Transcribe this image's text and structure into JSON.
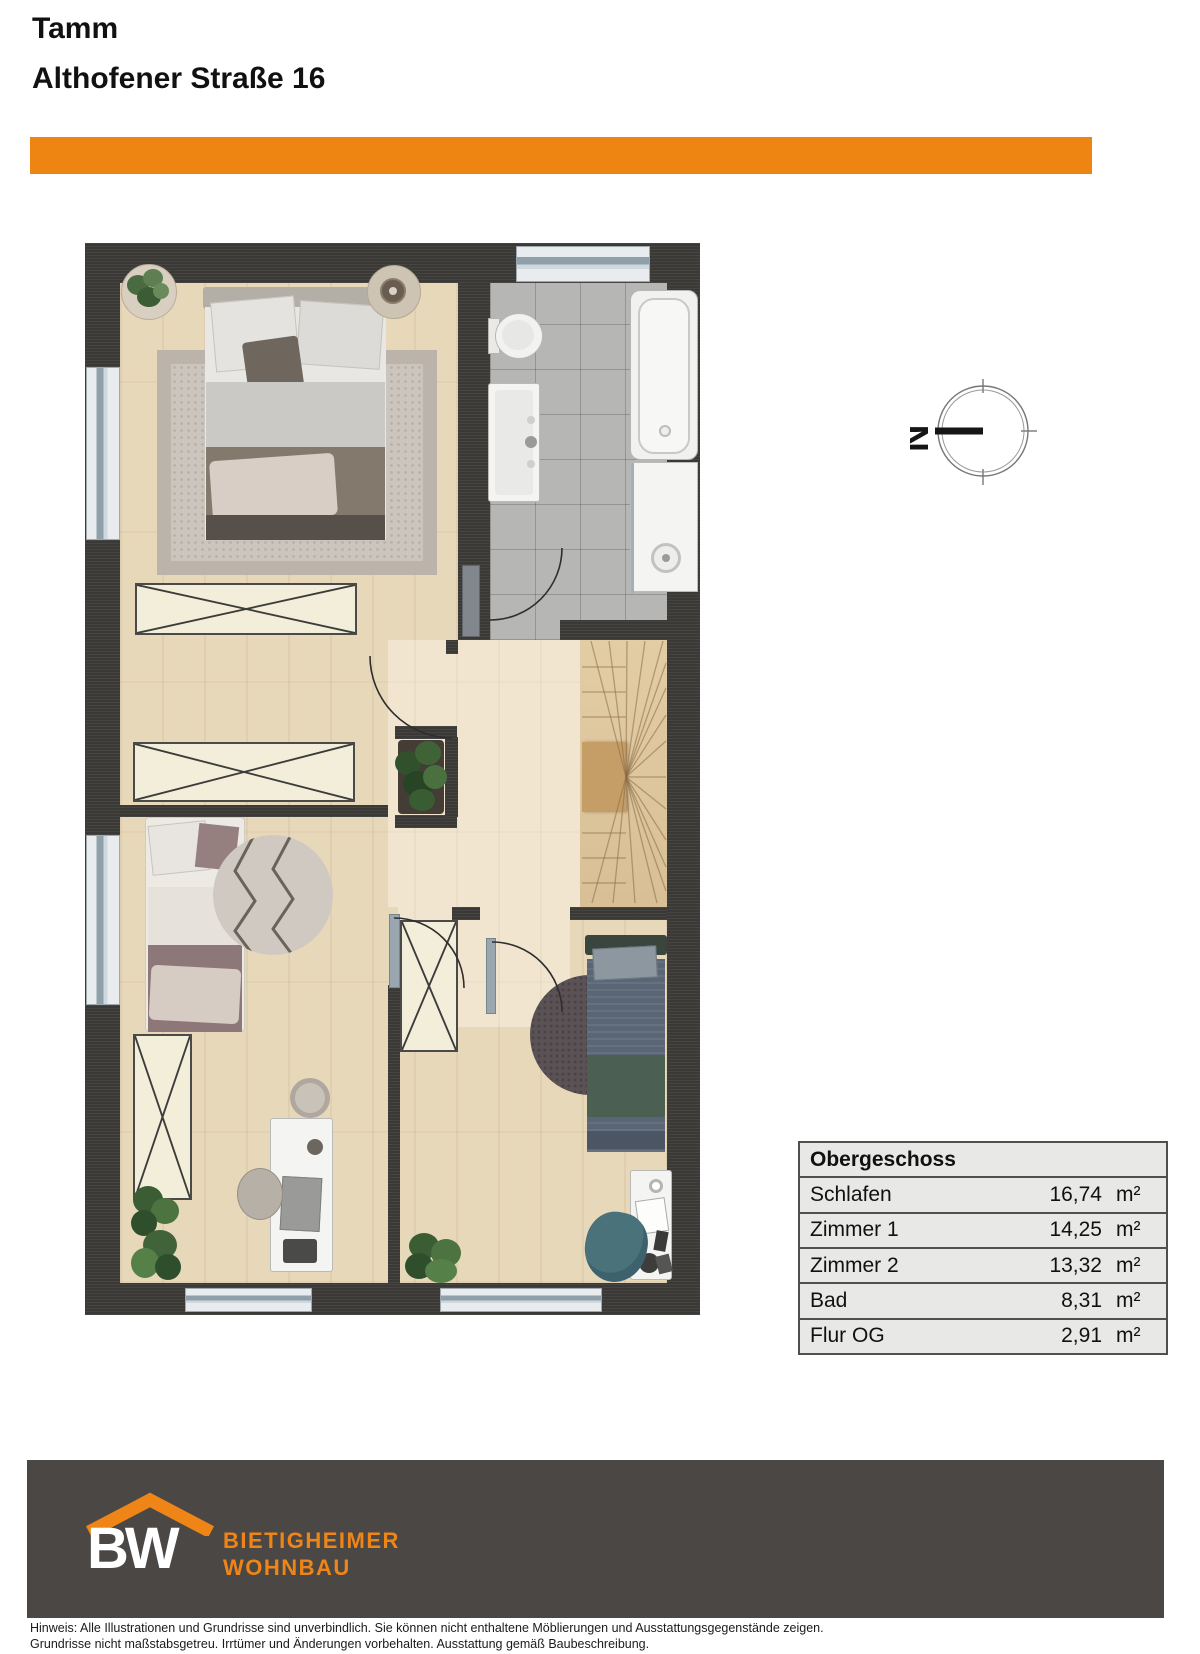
{
  "header": {
    "city": "Tamm",
    "address": "Althofener Straße 16"
  },
  "compass": {
    "label": "N"
  },
  "area_table": {
    "header": "Obergeschoss",
    "rows": [
      {
        "name": "Schlafen",
        "area": "16,74",
        "unit": "m²"
      },
      {
        "name": "Zimmer 1",
        "area": "14,25",
        "unit": "m²"
      },
      {
        "name": "Zimmer 2",
        "area": "13,32",
        "unit": "m²"
      },
      {
        "name": "Bad",
        "area": "8,31",
        "unit": "m²"
      },
      {
        "name": "Flur OG",
        "area": "2,91",
        "unit": "m²"
      }
    ]
  },
  "footer": {
    "logo_acronym": "BW",
    "brand_line1": "BIETIGHEIMER",
    "brand_line2": "WOHNBAU"
  },
  "disclaimer": {
    "line1": "Hinweis: Alle Illustrationen und Grundrisse sind unverbindlich. Sie können nicht enthaltene Möblierungen und Ausstattungsgegenstände zeigen.",
    "line2": "Grundrisse nicht maßstabsgetreu. Irrtümer und Änderungen vorbehalten. Ausstattung gemäß Baubeschreibung."
  },
  "colors": {
    "accent_orange": "#ee8411",
    "wall_dark": "#3b3936",
    "wood_floor": "#e8d8ba",
    "tile_gray": "#b6b6b4",
    "footer_gray": "#4a4745",
    "table_bg": "#e8e8e6"
  }
}
